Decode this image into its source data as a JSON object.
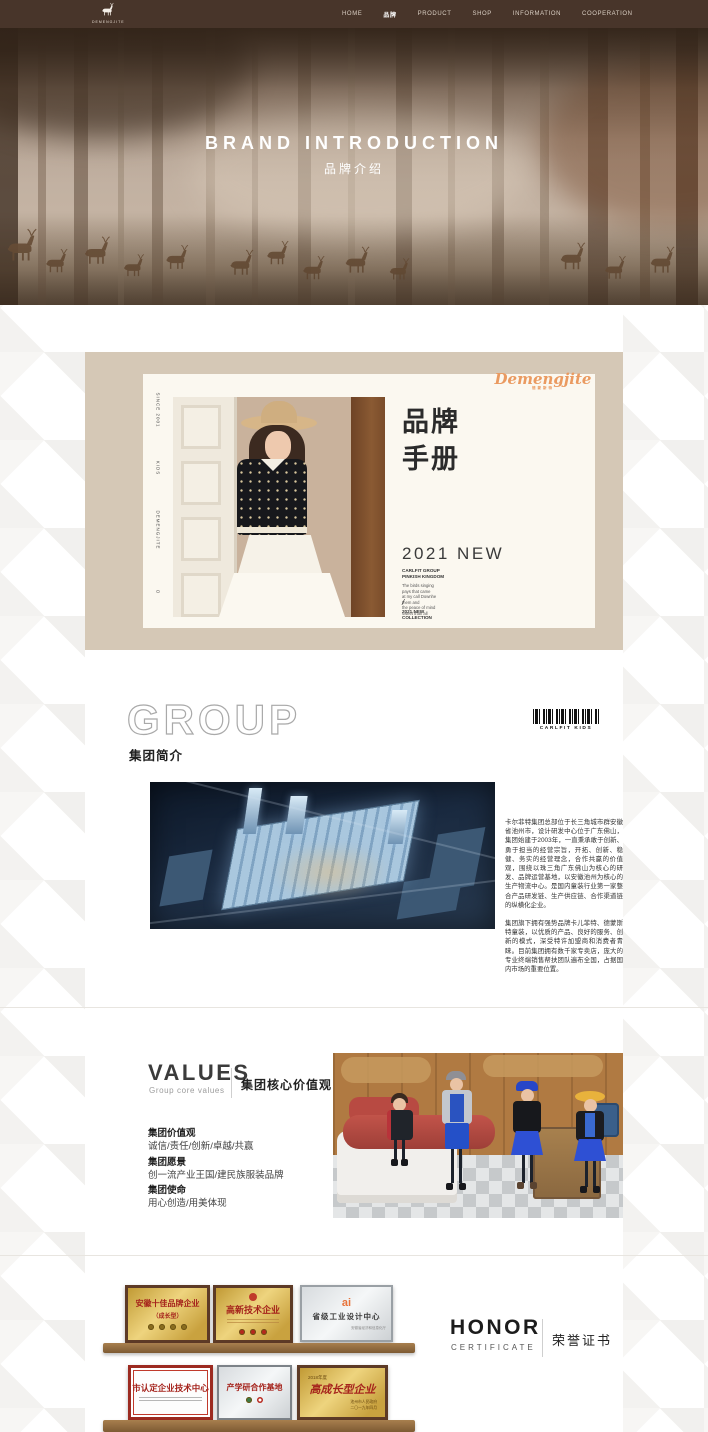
{
  "nav": {
    "logo_text": "DEMENGJITE",
    "items": [
      {
        "label": "HOME"
      },
      {
        "label": "品牌"
      },
      {
        "label": "PRODUCT"
      },
      {
        "label": "SHOP"
      },
      {
        "label": "INFORMATION"
      },
      {
        "label": "COOPERATION"
      }
    ]
  },
  "hero": {
    "title": "BRAND INTRODUCTION",
    "subtitle": "品牌介绍"
  },
  "brandbook": {
    "side_texts": [
      "SINCE 2001",
      "KIDS",
      "DEMENGJITE",
      "O"
    ],
    "script_logo": "Demengjite",
    "script_sub": "德蒙斯特",
    "title_line1": "品牌",
    "title_line2": "手册",
    "year": "2021 NEW",
    "caption_bold1": "CARLFIT GROUP",
    "caption_bold2": "PINKISH KINGDOM",
    "caption_lines": [
      "The birds singing",
      "pays that came",
      "at my call Downhe",
      "them and",
      "the peace of mind",
      "sweet than all"
    ],
    "slash": "/",
    "collection_line1": "2021 NEW",
    "collection_line2": "COLLECTION"
  },
  "group": {
    "heading_en": "GROUP",
    "heading_cn": "集团简介",
    "barcode_label": "CARLFIT KIDS",
    "para1": "卡尔菲特集团总部位于长三角城市群安徽省池州市，设计研发中心位于广东佛山，集团始建于2003年，一直秉承敢于创新、勇于担当的经营宗旨，开拓、创新、稳健、务实的经营理念，合作共赢的价值观，围绕以珠三角广东佛山为核心的研发、品牌运营基地，以安徽池州为核心的生产物流中心。是国内童装行业第一家整合产品研发链、生产供应链、合作渠道链的纵横化企业。",
    "para2": "集团旗下拥有强势品牌卡儿菲特、德蒙斯特童装，以优质的产品、良好的服务、创新的模式，深受特许加盟商和消费者青睐。目前集团拥有数千家专卖店，庞大的专业终端销售帮扶团队遍布全国，占据国内市场的重要位置。"
  },
  "values": {
    "heading_en": "VALUES",
    "heading_sub": "Group core values",
    "heading_cn": "集团核心价值观",
    "items": [
      {
        "title": "集团价值观",
        "text": "诚信/责任/创新/卓越/共赢"
      },
      {
        "title": "集团愿景",
        "text": "创一流产业王国/建民族服装品牌"
      },
      {
        "title": "集团使命",
        "text": "用心创造/用美体现"
      }
    ]
  },
  "honor": {
    "heading_en": "HONOR",
    "heading_sub": "CERTIFICATE",
    "heading_cn": "荣誉证书",
    "row1": [
      {
        "title": "安徽十佳品牌企业",
        "subtitle": "（成长型）"
      },
      {
        "title": "高新技术企业"
      },
      {
        "logo": "ai",
        "title": "省级工业设计中心",
        "footer": "安徽省经济和信息化厅"
      }
    ],
    "row2": [
      {
        "title": "市认定企业技术中心"
      },
      {
        "title": "产学研合作基地"
      },
      {
        "badge": "2018年度",
        "title": "高成长型企业",
        "footer1": "池州市人民政府",
        "footer2": "二〇一九年四月"
      }
    ]
  }
}
